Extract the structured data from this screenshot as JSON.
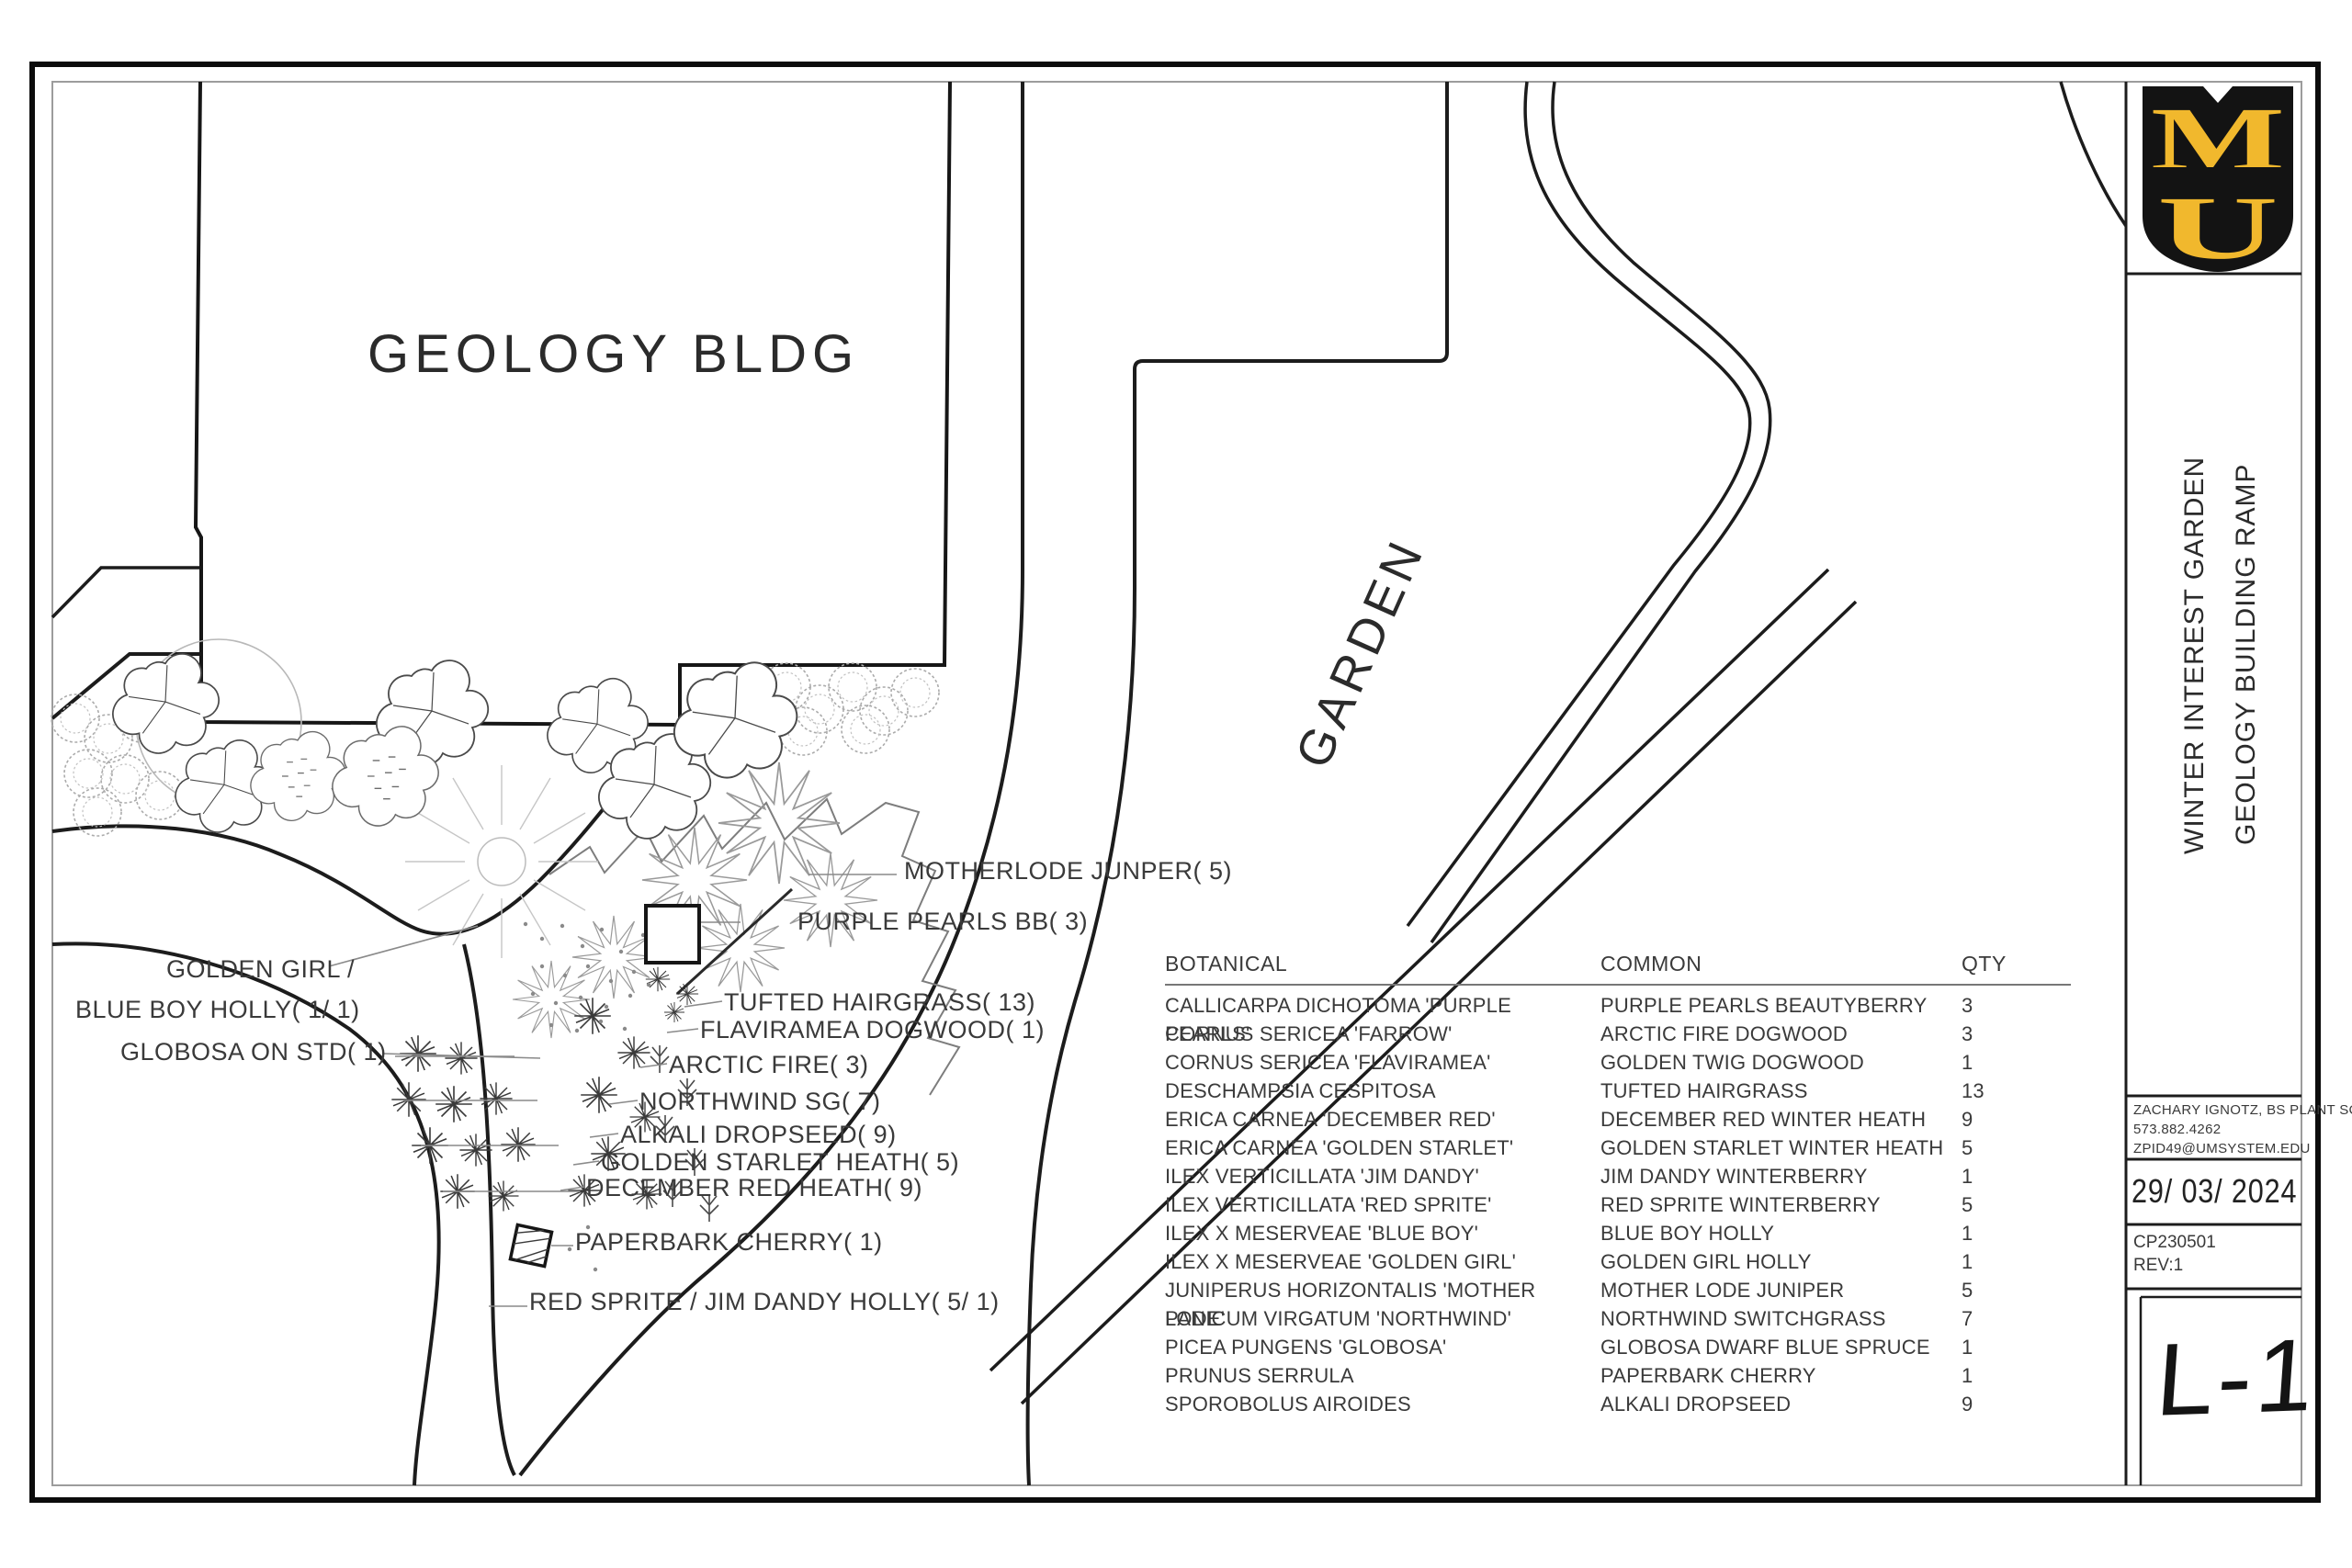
{
  "sheet": {
    "logo": {
      "letter_top": "M",
      "letter_bottom": "U",
      "shield_color": "#131313",
      "gold": "#F1B82D"
    },
    "titles": {
      "line1": "WINTER INTEREST GARDEN",
      "line2": "GEOLOGY BUILDING RAMP"
    },
    "contact": {
      "name": "ZACHARY IGNOTZ, BS PLANT SCI",
      "phone": "573.882.4262",
      "email": "ZPID49@UMSYSTEM.EDU"
    },
    "date": "29/ 03/ 2024",
    "project_no": "CP230501",
    "revision": "REV:1",
    "sheet_no": "L-1"
  },
  "plan": {
    "building_label": "GEOLOGY BLDG",
    "area_label": "GARDEN",
    "callouts": [
      {
        "text": "MOTHERLODE JUNPER( 5)"
      },
      {
        "text": "PURPLE PEARLS BB( 3)"
      },
      {
        "text": "TUFTED HAIRGRASS( 13)"
      },
      {
        "text": "FLAVIRAMEA DOGWOOD( 1)"
      },
      {
        "text": "ARCTIC FIRE( 3)"
      },
      {
        "text": "NORTHWIND SG( 7)"
      },
      {
        "text": "ALKALI DROPSEED( 9)"
      },
      {
        "text": "GOLDEN STARLET HEATH( 5)"
      },
      {
        "text": "DECEMBER RED HEATH( 9)"
      },
      {
        "text": "PAPERBARK CHERRY( 1)"
      },
      {
        "text": "RED SPRITE / JIM DANDY HOLLY( 5/ 1)"
      },
      {
        "text": "GOLDEN GIRL /"
      },
      {
        "text": "BLUE BOY HOLLY( 1/ 1)"
      },
      {
        "text": "GLOBOSA ON STD( 1)"
      }
    ]
  },
  "schedule": {
    "headers": [
      "BOTANICAL",
      "COMMON",
      "QTY"
    ],
    "rows": [
      [
        "CALLICARPA DICHOTOMA 'PURPLE PEARLS'",
        "PURPLE PEARLS BEAUTYBERRY",
        "3"
      ],
      [
        "CORNUS SERICEA 'FARROW'",
        "ARCTIC FIRE DOGWOOD",
        "3"
      ],
      [
        "CORNUS SERICEA 'FLAVIRAMEA'",
        "GOLDEN TWIG DOGWOOD",
        "1"
      ],
      [
        "DESCHAMPSIA CESPITOSA",
        "TUFTED HAIRGRASS",
        "13"
      ],
      [
        "ERICA CARNEA 'DECEMBER RED'",
        "DECEMBER RED WINTER HEATH",
        "9"
      ],
      [
        "ERICA CARNEA 'GOLDEN STARLET'",
        "GOLDEN STARLET WINTER HEATH",
        "5"
      ],
      [
        "ILEX VERTICILLATA 'JIM DANDY'",
        "JIM DANDY WINTERBERRY",
        "1"
      ],
      [
        "ILEX VERTICILLATA 'RED SPRITE'",
        "RED SPRITE WINTERBERRY",
        "5"
      ],
      [
        "ILEX X MESERVEAE 'BLUE BOY'",
        "BLUE BOY HOLLY",
        "1"
      ],
      [
        "ILEX X MESERVEAE 'GOLDEN GIRL'",
        "GOLDEN GIRL HOLLY",
        "1"
      ],
      [
        "JUNIPERUS HORIZONTALIS 'MOTHER LODE'",
        "MOTHER LODE JUNIPER",
        "5"
      ],
      [
        "PANICUM VIRGATUM 'NORTHWIND'",
        "NORTHWIND SWITCHGRASS",
        "7"
      ],
      [
        "PICEA PUNGENS 'GLOBOSA'",
        "GLOBOSA DWARF BLUE SPRUCE",
        "1"
      ],
      [
        "PRUNUS SERRULA",
        "PAPERBARK CHERRY",
        "1"
      ],
      [
        "SPOROBOLUS AIROIDES",
        "ALKALI DROPSEED",
        "9"
      ]
    ]
  }
}
